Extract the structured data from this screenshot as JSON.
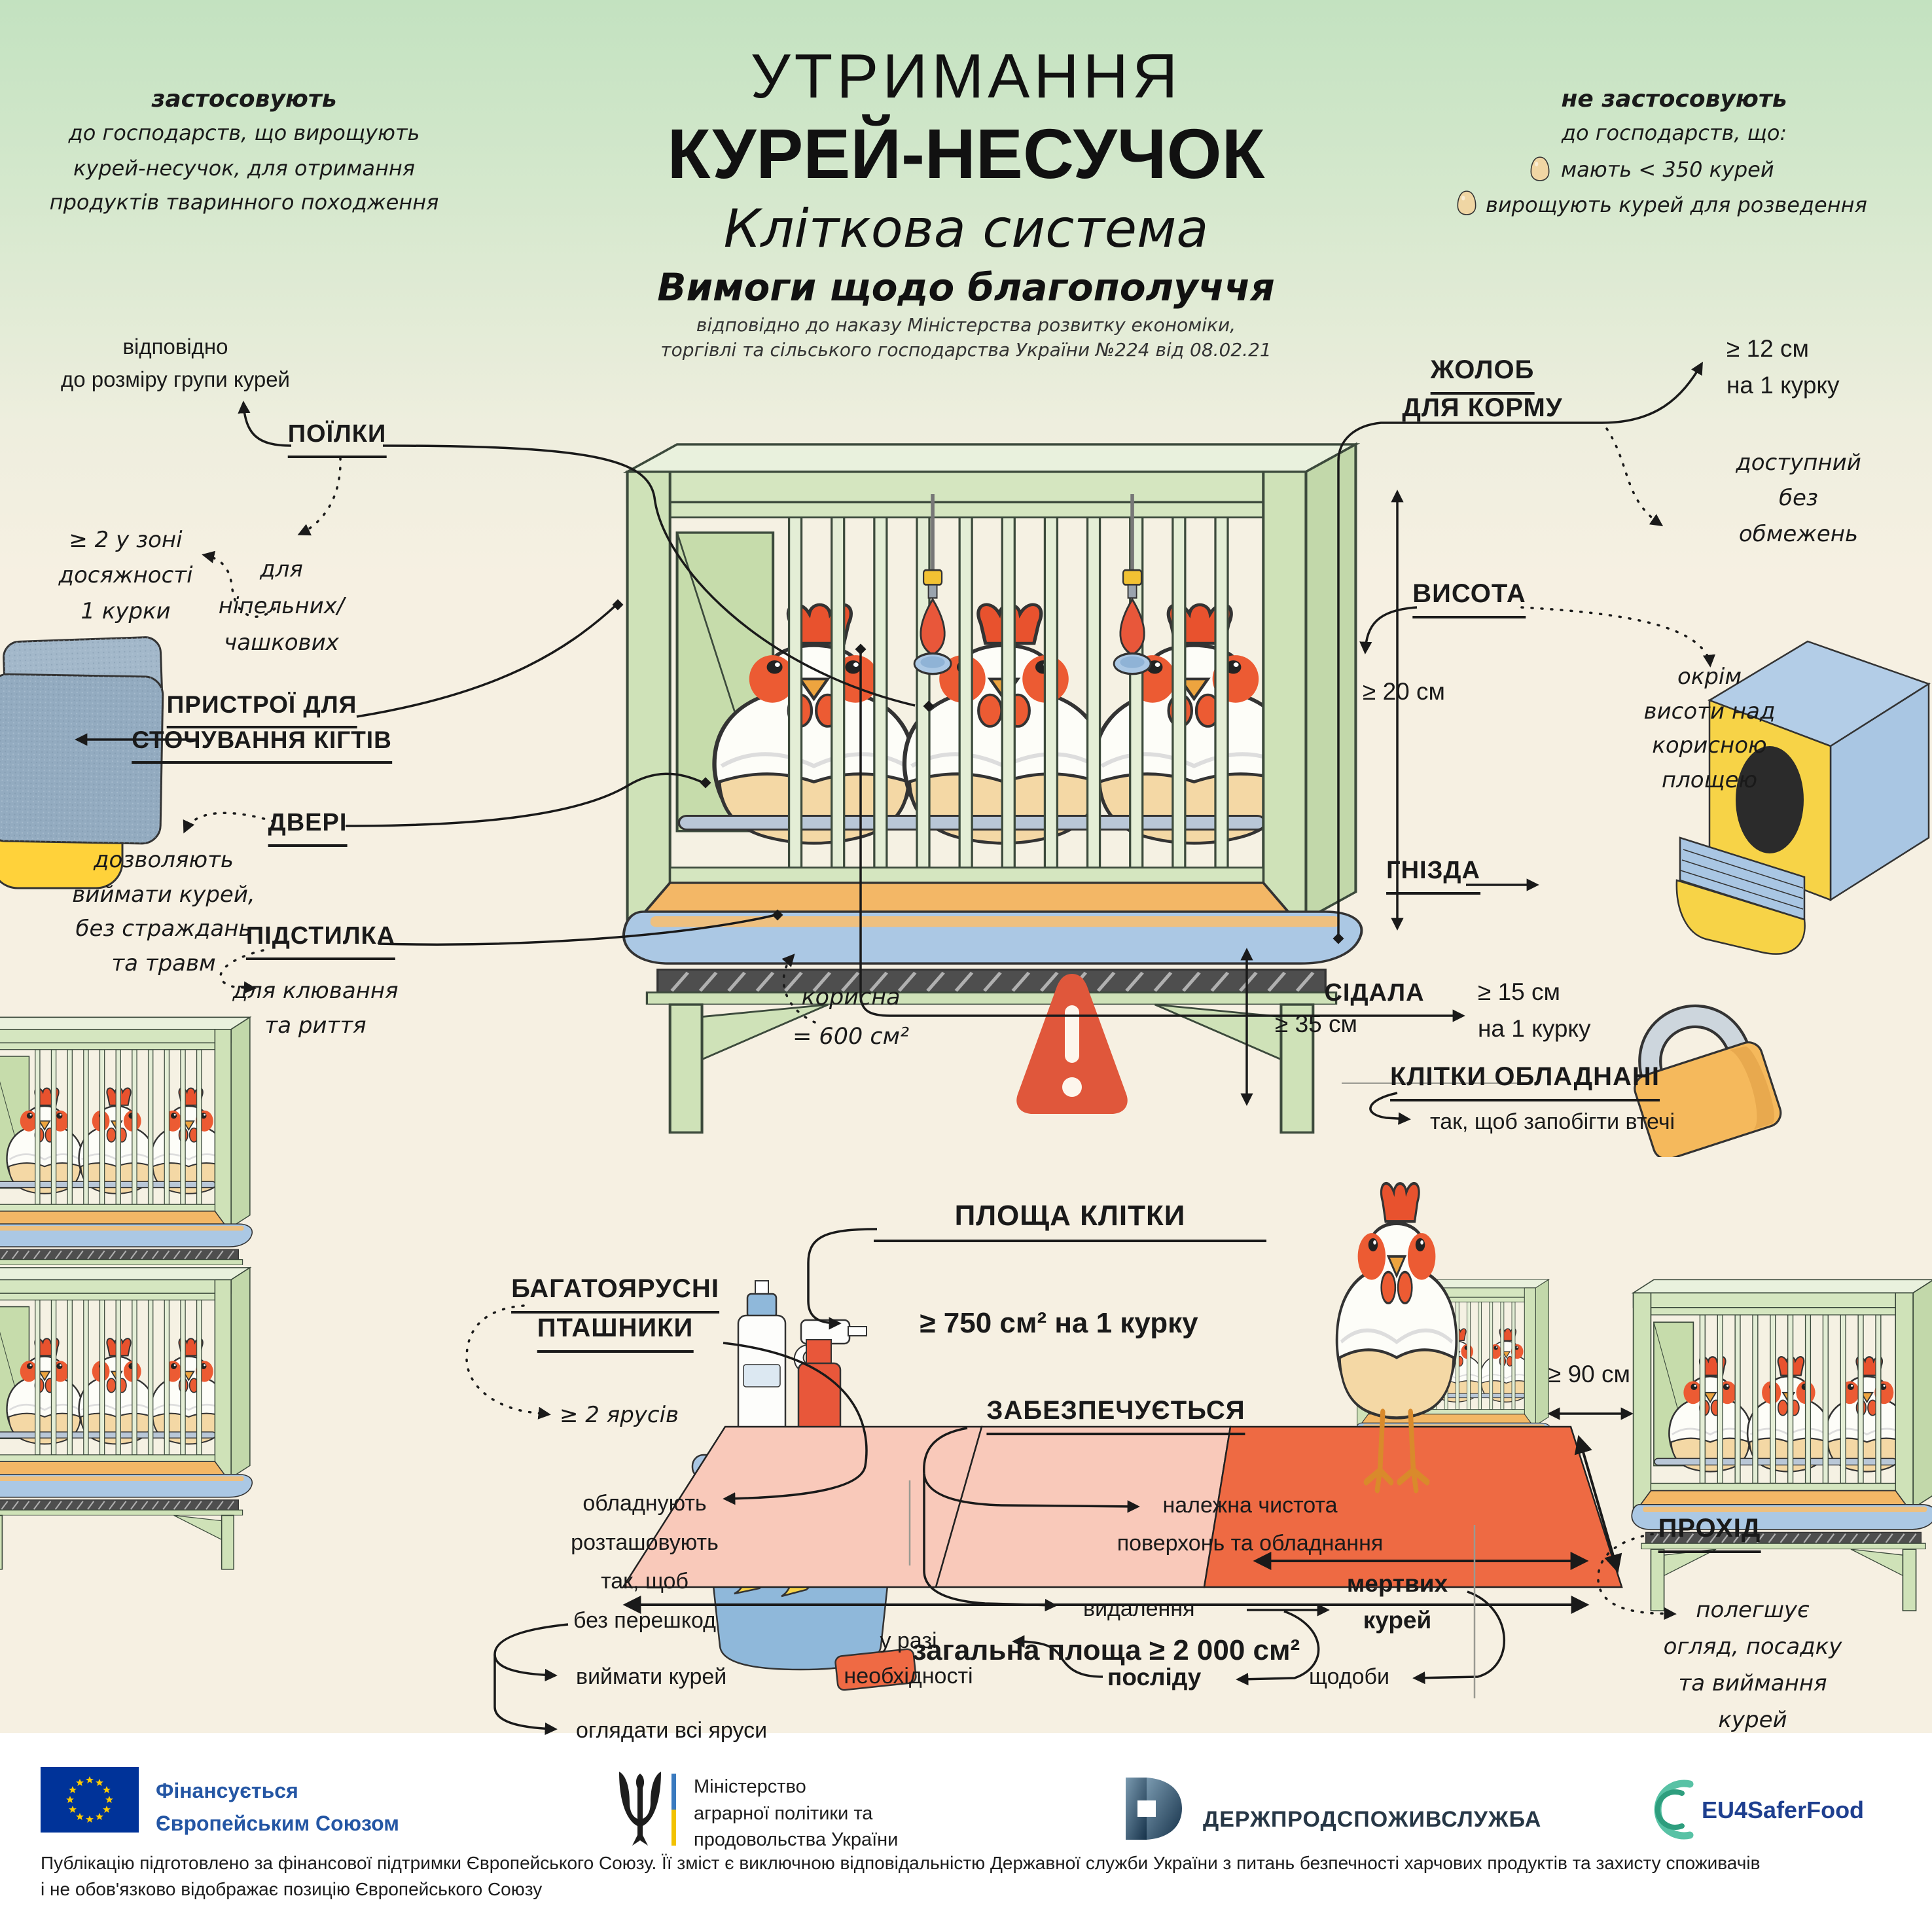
{
  "header": {
    "apply": {
      "title": "застосовують",
      "line1": "до господарств, що вирощують",
      "line2": "курей-несучок, для отримання",
      "line3": "продуктів тваринного походження"
    },
    "title_line1": "УТРИМАННЯ",
    "title_line2": "КУРЕЙ-НЕСУЧОК",
    "subtitle": "Кліткова система",
    "subtitle2": "Вимоги щодо благополуччя",
    "order_note": "відповідно до наказу Міністерства розвитку економіки,\nторгівлі та сільського господарства України №224 від 08.02.21",
    "not_apply": {
      "title": "не застосовують",
      "subtitle": "до господарств, що:",
      "items": [
        {
          "label": "мають < 350 курей"
        },
        {
          "label": "вирощують курей для розведення"
        }
      ]
    }
  },
  "sections": {
    "drinkers": {
      "header": "ПОЇЛКИ",
      "note_group": "відповідно\nдо розміру групи курей",
      "note_count": "≥ 2 у зоні\nдосяжності\n1 курки",
      "note_type": "для\nніпельних/\nчашкових"
    },
    "feed_trough": {
      "header_line1": "ЖОЛОБ",
      "header_line2": "ДЛЯ КОРМУ",
      "value": "≥ 12 см\nна 1 курку",
      "note": "доступний\nбез\nобмежень"
    },
    "height": {
      "header": "ВИСОТА",
      "value": "≥ 20 см",
      "note": "окрім\nвисоти над\nкорисною\nплощею"
    },
    "claw_devices": {
      "header_line1": "ПРИСТРОЇ ДЛЯ",
      "header_line2": "СТОЧУВАННЯ КІГТІВ"
    },
    "doors": {
      "header": "ДВЕРІ",
      "note": "дозволяють\nвиймати курей,\nбез страждань\nта травм"
    },
    "litter": {
      "header": "ПІДСТИЛКА",
      "note": "для клювання\nта риття"
    },
    "nests": {
      "header": "ГНІЗДА"
    },
    "perches": {
      "header": "СІДАЛА",
      "value": "≥ 15 см\nна 1 курку"
    },
    "cage_area": {
      "header": "ПЛОЩА КЛІТКИ",
      "useful_label": "корисна\n= 600 см²",
      "min_gap": "≥ 35 см",
      "per_hen": "≥  750 см² на 1 курку",
      "total": "загальна площа ≥ 2 000 см²"
    },
    "equipped": {
      "header": "КЛІТКИ ОБЛАДНАНІ",
      "note": "так, щоб запобігти втечі"
    },
    "multi_tier": {
      "header_line1": "БАГАТОЯРУСНІ",
      "header_line2": "ПТАШНИКИ",
      "tiers": "≥ 2 ярусів",
      "body": "обладнують\nрозташовують\nтак, щоб\nбез перешкод",
      "bullet1": "виймати курей",
      "bullet2": "оглядати всі яруси"
    },
    "ensured": {
      "header": "ЗАБЕЗПЕЧУЄТЬСЯ",
      "clean": "належна чистота\nповерхонь та обладнання",
      "removal": "видалення",
      "dead": "мертвих\nкурей",
      "daily": "щодоби",
      "droppings": "посліду",
      "as_needed": "у разі\nнеобхідності"
    },
    "aisle": {
      "header": "ПРОХІД",
      "value": "≥ 90 см",
      "note": "полегшує\nогляд, посадку\nта виймання курей"
    }
  },
  "footer": {
    "eu_label": "Фінансується\nЄвропейським Союзом",
    "ministry_label": "Міністерство\nаграрної політики та\nпродовольства України",
    "service_label": "ДЕРЖПРОДСПОЖИВСЛУЖБА",
    "eu4_label": "EU4SaferFood",
    "disclaimer_line1": "Публікацію підготовлено за фінансової підтримки Європейського Союзу. Її зміст є виключною відповідальністю Державної служби України з питань безпечності харчових продуктів та захисту споживачів",
    "disclaimer_line2": "і не обов'язково відображає позицію Європейського Союзу"
  },
  "colors": {
    "accent_orange": "#e8573a",
    "frame_green": "#d5e6c0",
    "trough_blue": "#abc8e4",
    "yellow": "#f7d347",
    "mat_pink": "#f9c9ba",
    "mat_orange": "#ee6a43",
    "bg_cream": "#f6f0e2",
    "bg_green": "#c3e2c0",
    "eu_blue": "#003399",
    "brand_blue": "#2456a4"
  },
  "icons": [
    "egg-icon",
    "warning-icon",
    "padlock-icon",
    "hen-icon",
    "cage-icon",
    "nest-box-icon",
    "cleaning-kit-icon",
    "claw-abrasive-icon",
    "eu-flag-icon",
    "trident-icon",
    "service-logo-icon",
    "eu4saferfood-icon"
  ]
}
